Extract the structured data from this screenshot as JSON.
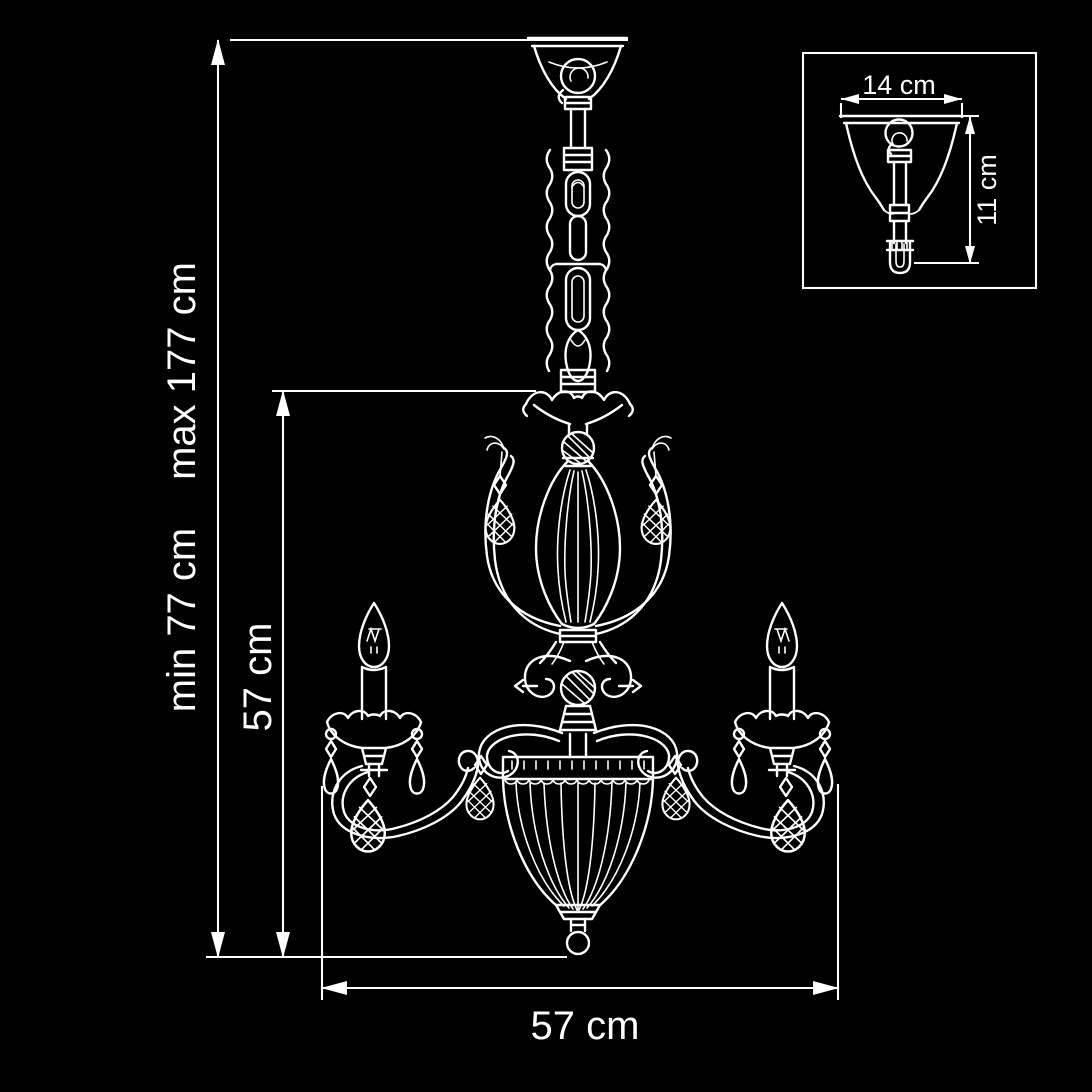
{
  "page": {
    "background_color": "#000000",
    "line_color": "#ffffff"
  },
  "diagram": {
    "subject": "chandelier-technical-dimension-drawing",
    "labels": {
      "height_min": "min 77 cm",
      "height_max": "max 177 cm",
      "upper_drop": "57 cm",
      "width": "57 cm"
    },
    "inset": {
      "width": "14 cm",
      "height": "11 cm"
    }
  }
}
